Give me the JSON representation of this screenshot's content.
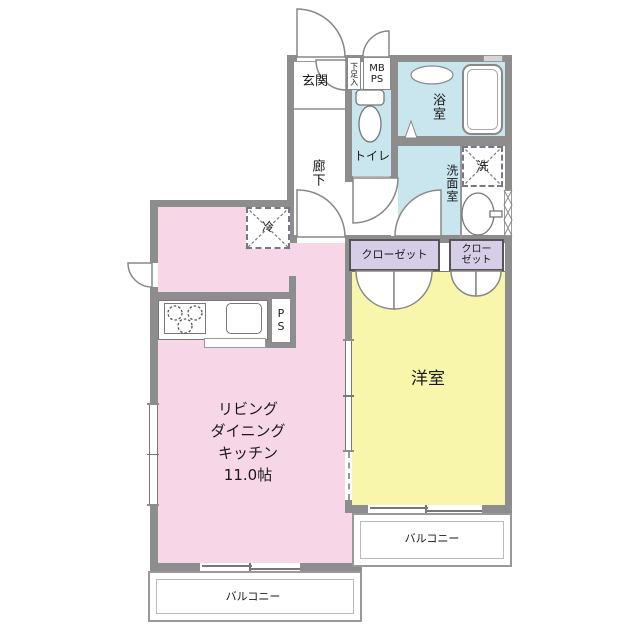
{
  "plan": {
    "entrance": "玄関",
    "shoe_box": "下足入",
    "meter_box": [
      "MB",
      "PS"
    ],
    "hallway": "廊下",
    "toilet": "トイレ",
    "bathroom": "浴室",
    "washroom": "洗面室",
    "washer": "洗",
    "fridge": "冷",
    "pipe_space": [
      "P",
      "S"
    ],
    "closet_main": "クローゼット",
    "closet_sub": [
      "クロー",
      "ゼット"
    ],
    "western_room": "洋室",
    "ldk": [
      "リビング",
      "ダイニング",
      "キッチン",
      "11.0帖"
    ],
    "balcony_right": "バルコニー",
    "balcony_bottom": "バルコニー"
  },
  "colors": {
    "ldk_pink": "#f7d7e7",
    "western_yellow": "#f8f6ab",
    "wet_area_blue": "#c9e6ee",
    "closet_purple": "#d6cde6",
    "wall_gray": "#8d8d8d"
  }
}
